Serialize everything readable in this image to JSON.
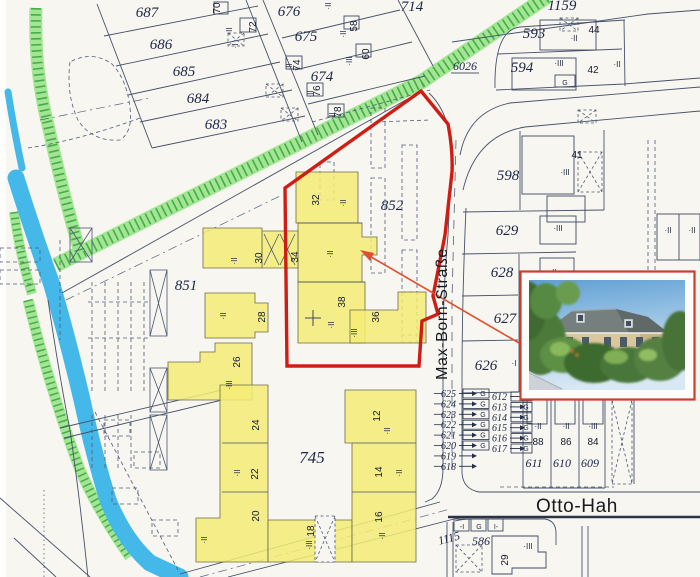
{
  "map": {
    "colors": {
      "paper": "#f8f6f0",
      "boundary_red": "#cf1d15",
      "arrow_red": "#e04f30",
      "highlight_yellow": "#f4ec75",
      "vegetation_green": "#a2e593",
      "hatch_green": "#2f9e38",
      "water_blue": "#44b9e9",
      "line_ink": "#46526b"
    },
    "labels": [
      {
        "t": "687",
        "x": 147,
        "y": 17,
        "c": "parcel"
      },
      {
        "t": "686",
        "x": 161,
        "y": 49,
        "c": "parcel"
      },
      {
        "t": "685",
        "x": 184,
        "y": 76,
        "c": "parcel"
      },
      {
        "t": "684",
        "x": 198,
        "y": 103,
        "c": "parcel"
      },
      {
        "t": "683",
        "x": 216,
        "y": 129,
        "c": "parcel"
      },
      {
        "t": "676",
        "x": 289,
        "y": 16,
        "c": "parcel"
      },
      {
        "t": "675",
        "x": 306,
        "y": 41,
        "c": "parcel"
      },
      {
        "t": "674",
        "x": 322,
        "y": 81,
        "c": "parcel"
      },
      {
        "t": "714",
        "x": 412,
        "y": 11,
        "c": "parcel"
      },
      {
        "t": "1159",
        "x": 562,
        "y": 10,
        "c": "parcel"
      },
      {
        "t": "593",
        "x": 534,
        "y": 38,
        "c": "parcel"
      },
      {
        "t": "594",
        "x": 522,
        "y": 72,
        "c": "parcel"
      },
      {
        "t": "6026",
        "x": 465,
        "y": 70,
        "c": "parcel-sm",
        "u": 1
      },
      {
        "t": "598",
        "x": 508,
        "y": 180,
        "c": "parcel"
      },
      {
        "t": "629",
        "x": 507,
        "y": 235,
        "c": "parcel"
      },
      {
        "t": "628",
        "x": 502,
        "y": 277,
        "c": "parcel"
      },
      {
        "t": "627",
        "x": 505,
        "y": 323,
        "c": "parcel"
      },
      {
        "t": "626",
        "x": 486,
        "y": 370,
        "c": "parcel"
      },
      {
        "t": "852",
        "x": 392,
        "y": 210,
        "c": "parcel"
      },
      {
        "t": "851",
        "x": 186,
        "y": 290,
        "c": "parcel"
      },
      {
        "t": "745",
        "x": 312,
        "y": 463,
        "c": "parcel-lg"
      },
      {
        "t": "1115",
        "x": 450,
        "y": 542,
        "c": "parcel-sm",
        "r": -15
      },
      {
        "t": "586",
        "x": 481,
        "y": 545,
        "c": "parcel-sm"
      },
      {
        "t": "611",
        "x": 534,
        "y": 467,
        "c": "parcel-sm"
      },
      {
        "t": "610",
        "x": 562,
        "y": 467,
        "c": "parcel-sm"
      },
      {
        "t": "609",
        "x": 590,
        "y": 467,
        "c": "parcel-sm"
      },
      {
        "t": "70",
        "x": 220,
        "y": 8,
        "c": "house",
        "r": -90
      },
      {
        "t": "72",
        "x": 256,
        "y": 27,
        "c": "house",
        "r": -90
      },
      {
        "t": "74",
        "x": 300,
        "y": 65,
        "c": "house",
        "r": -90
      },
      {
        "t": "76",
        "x": 320,
        "y": 91,
        "c": "house",
        "r": -90
      },
      {
        "t": "78",
        "x": 341,
        "y": 112,
        "c": "house",
        "r": -90
      },
      {
        "t": "58",
        "x": 357,
        "y": 26,
        "c": "house",
        "r": -90
      },
      {
        "t": "60",
        "x": 369,
        "y": 54,
        "c": "house",
        "r": -90
      },
      {
        "t": "44",
        "x": 594,
        "y": 33,
        "c": "house"
      },
      {
        "t": "42",
        "x": 593,
        "y": 73,
        "c": "house"
      },
      {
        "t": "41",
        "x": 577,
        "y": 158,
        "c": "house"
      },
      {
        "t": "32",
        "x": 319,
        "y": 200,
        "c": "house",
        "r": -90
      },
      {
        "t": "34",
        "x": 298,
        "y": 257,
        "c": "house",
        "r": -90
      },
      {
        "t": "38",
        "x": 345,
        "y": 302,
        "c": "house",
        "r": -90
      },
      {
        "t": "36",
        "x": 379,
        "y": 317,
        "c": "house",
        "r": -90
      },
      {
        "t": "30",
        "x": 262,
        "y": 258,
        "c": "house",
        "r": -90
      },
      {
        "t": "28",
        "x": 265,
        "y": 317,
        "c": "house",
        "r": -90
      },
      {
        "t": "26",
        "x": 240,
        "y": 362,
        "c": "house",
        "r": -90
      },
      {
        "t": "24",
        "x": 259,
        "y": 425,
        "c": "house",
        "r": -90
      },
      {
        "t": "22",
        "x": 258,
        "y": 474,
        "c": "house",
        "r": -90
      },
      {
        "t": "20",
        "x": 259,
        "y": 516,
        "c": "house",
        "r": -90
      },
      {
        "t": "18",
        "x": 314,
        "y": 531,
        "c": "house",
        "r": -90
      },
      {
        "t": "16",
        "x": 382,
        "y": 517,
        "c": "house",
        "r": -90
      },
      {
        "t": "14",
        "x": 382,
        "y": 472,
        "c": "house",
        "r": -90
      },
      {
        "t": "12",
        "x": 380,
        "y": 416,
        "c": "house",
        "r": -90
      },
      {
        "t": "88",
        "x": 538,
        "y": 445,
        "c": "house"
      },
      {
        "t": "86",
        "x": 566,
        "y": 445,
        "c": "house"
      },
      {
        "t": "84",
        "x": 593,
        "y": 445,
        "c": "house"
      },
      {
        "t": "29",
        "x": 508,
        "y": 560,
        "c": "house",
        "r": -90
      },
      {
        "t": "·II",
        "x": 346,
        "y": 203,
        "c": "story",
        "r": -90
      },
      {
        "t": "·II",
        "x": 333,
        "y": 254,
        "c": "story",
        "r": -90
      },
      {
        "t": "·II",
        "x": 334,
        "y": 325,
        "c": "story",
        "r": -90
      },
      {
        "t": "·III",
        "x": 357,
        "y": 333,
        "c": "story",
        "r": -90
      },
      {
        "t": "·II",
        "x": 237,
        "y": 261,
        "c": "story",
        "r": -90
      },
      {
        "t": "·II",
        "x": 226,
        "y": 316,
        "c": "story",
        "r": -90
      },
      {
        "t": "·III",
        "x": 232,
        "y": 385,
        "c": "story",
        "r": -90
      },
      {
        "t": "·II",
        "x": 240,
        "y": 473,
        "c": "story",
        "r": -90
      },
      {
        "t": "·II",
        "x": 207,
        "y": 540,
        "c": "story",
        "r": -90
      },
      {
        "t": "·III",
        "x": 312,
        "y": 545,
        "c": "story",
        "r": -90
      },
      {
        "t": "·II",
        "x": 385,
        "y": 536,
        "c": "story",
        "r": -90
      },
      {
        "t": "·II",
        "x": 402,
        "y": 473,
        "c": "story",
        "r": -90
      },
      {
        "t": "·II",
        "x": 390,
        "y": 431,
        "c": "story",
        "r": -90
      },
      {
        "t": "·II",
        "x": 232,
        "y": 31,
        "c": "story",
        "r": -90
      },
      {
        "t": "·I",
        "x": 238,
        "y": 46,
        "c": "story",
        "r": -90
      },
      {
        "t": "·II",
        "x": 292,
        "y": 67,
        "c": "story",
        "r": -90
      },
      {
        "t": "·II",
        "x": 313,
        "y": 94,
        "c": "story",
        "r": -90
      },
      {
        "t": "·II",
        "x": 335,
        "y": 116,
        "c": "story",
        "r": -90
      },
      {
        "t": "·II",
        "x": 346,
        "y": 34,
        "c": "story",
        "r": -90
      },
      {
        "t": "·III",
        "x": 352,
        "y": 61,
        "c": "story",
        "r": -90
      },
      {
        "t": "·II",
        "x": 331,
        "y": 6,
        "c": "story",
        "r": -90
      },
      {
        "t": "·II",
        "x": 574,
        "y": 41,
        "c": "story"
      },
      {
        "t": "·III",
        "x": 559,
        "y": 66,
        "c": "story"
      },
      {
        "t": "·III",
        "x": 565,
        "y": 175,
        "c": "story"
      },
      {
        "t": "·III",
        "x": 558,
        "y": 231,
        "c": "story"
      },
      {
        "t": "·II",
        "x": 553,
        "y": 275,
        "c": "story"
      },
      {
        "t": "·II",
        "x": 538,
        "y": 429,
        "c": "story"
      },
      {
        "t": "·II",
        "x": 566,
        "y": 429,
        "c": "story"
      },
      {
        "t": "·III",
        "x": 593,
        "y": 429,
        "c": "story"
      },
      {
        "t": "·III",
        "x": 528,
        "y": 549,
        "c": "story"
      },
      {
        "t": "·I",
        "x": 514,
        "y": 366,
        "c": "story"
      },
      {
        "t": "·II",
        "x": 668,
        "y": 233,
        "c": "story"
      },
      {
        "t": "·II",
        "x": 692,
        "y": 233,
        "c": "story"
      },
      {
        "t": "·II",
        "x": 617,
        "y": 67,
        "c": "story"
      },
      {
        "t": "G",
        "x": 565,
        "y": 85,
        "c": "tiny"
      },
      {
        "t": "-I",
        "x": 462,
        "y": 529,
        "c": "tiny"
      },
      {
        "t": "G",
        "x": 479,
        "y": 529,
        "c": "tiny"
      },
      {
        "t": "I-",
        "x": 496,
        "y": 529,
        "c": "tiny"
      },
      {
        "t": "Max-Born-Straße",
        "x": 447,
        "y": 314,
        "c": "street",
        "r": -90,
        "n": "street-label-max-born-strasse"
      },
      {
        "t": "Otto-Hah",
        "x": 577,
        "y": 512,
        "c": "street-lg",
        "n": "street-label-otto-hahn"
      }
    ],
    "garage_rows": [
      {
        "side": "left",
        "numbers": [
          "625",
          "624",
          "623",
          "622",
          "621",
          "620",
          "619",
          "618"
        ],
        "x": 456,
        "y0": 397,
        "dy": 10.4,
        "box_x": 463,
        "box_w": 26,
        "box_h": 9,
        "box_count": 6,
        "g_count": 6,
        "g": "G",
        "leader": true
      },
      {
        "side": "right",
        "numbers": [
          "612",
          "613",
          "614",
          "615",
          "616",
          "617"
        ],
        "x": 507,
        "y0": 400,
        "dy": 10.4,
        "box_x": 511,
        "box_w": 21,
        "box_h": 9,
        "box_count": 6,
        "g_count": 6,
        "g": "G",
        "leader": false
      }
    ]
  }
}
